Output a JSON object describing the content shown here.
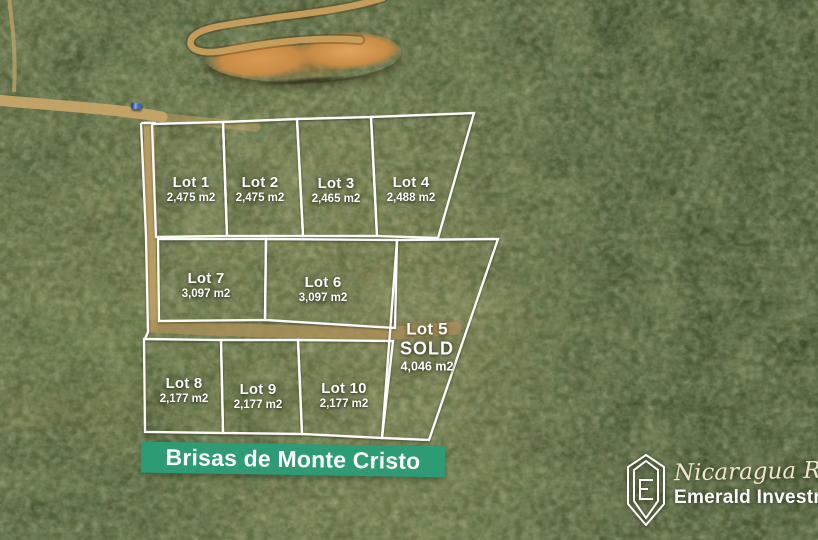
{
  "banner": {
    "label": "Brisas de Monte Cristo",
    "bg_color": "#2d9b73",
    "text_color": "#ffffff"
  },
  "overlay": {
    "line_color": "#ffffff"
  },
  "lots": [
    {
      "name": "Lot 1",
      "area": "2,475 m2",
      "polygon": "152,124 223,122 227,236 156,237",
      "label": {
        "x": 191,
        "y": 190
      }
    },
    {
      "name": "Lot 2",
      "area": "2,475 m2",
      "polygon": "223,122 297,119 303,236 227,236",
      "label": {
        "x": 260,
        "y": 190
      }
    },
    {
      "name": "Lot 3",
      "area": "2,465 m2",
      "polygon": "297,119 371,117 377,236 303,236",
      "label": {
        "x": 336,
        "y": 191
      }
    },
    {
      "name": "Lot 4",
      "area": "2,488 m2",
      "polygon": "371,117 474,113 438,238 377,236",
      "label": {
        "x": 411,
        "y": 190
      }
    },
    {
      "name": "Lot 7",
      "area": "3,097 m2",
      "polygon": "158,239 266,239 265,320 159,321",
      "label": {
        "x": 206,
        "y": 286
      }
    },
    {
      "name": "Lot 6",
      "area": "3,097 m2",
      "polygon": "266,239 397,240 395,328 265,320",
      "label": {
        "x": 323,
        "y": 290
      }
    },
    {
      "name": "Lot 5",
      "area": "4,046 m2",
      "status": "SOLD",
      "polygon": "397,240 498,239 429,440 382,438",
      "label": {
        "x": 427,
        "y": 347
      }
    },
    {
      "name": "Lot 8",
      "area": "2,177 m2",
      "polygon": "144,339 221,340 223,433 145,432",
      "label": {
        "x": 184,
        "y": 391
      }
    },
    {
      "name": "Lot 9",
      "area": "2,177 m2",
      "polygon": "221,340 298,340 302,434 223,433",
      "label": {
        "x": 258,
        "y": 397
      }
    },
    {
      "name": "Lot 10",
      "area": "2,177 m2",
      "polygon": "298,340 393,341 382,438 302,434",
      "label": {
        "x": 344,
        "y": 396
      }
    }
  ],
  "extra_boundaries": [
    {
      "points": "141,123 156,123"
    },
    {
      "points": "141,123 146,236 148,332 145,339"
    }
  ],
  "logo": {
    "script_text": "Nicaragua Real Estate",
    "brand_text": "Emerald Investments",
    "icon": "emerald-gem-outline"
  },
  "photo": {
    "features": [
      "dirt-road-left",
      "dirt-trail-top-left",
      "switchback-road-top",
      "excavated-dirt-area",
      "blue-pickup-truck",
      "dirt-corridor-left",
      "dirt-corridor-middle"
    ]
  }
}
